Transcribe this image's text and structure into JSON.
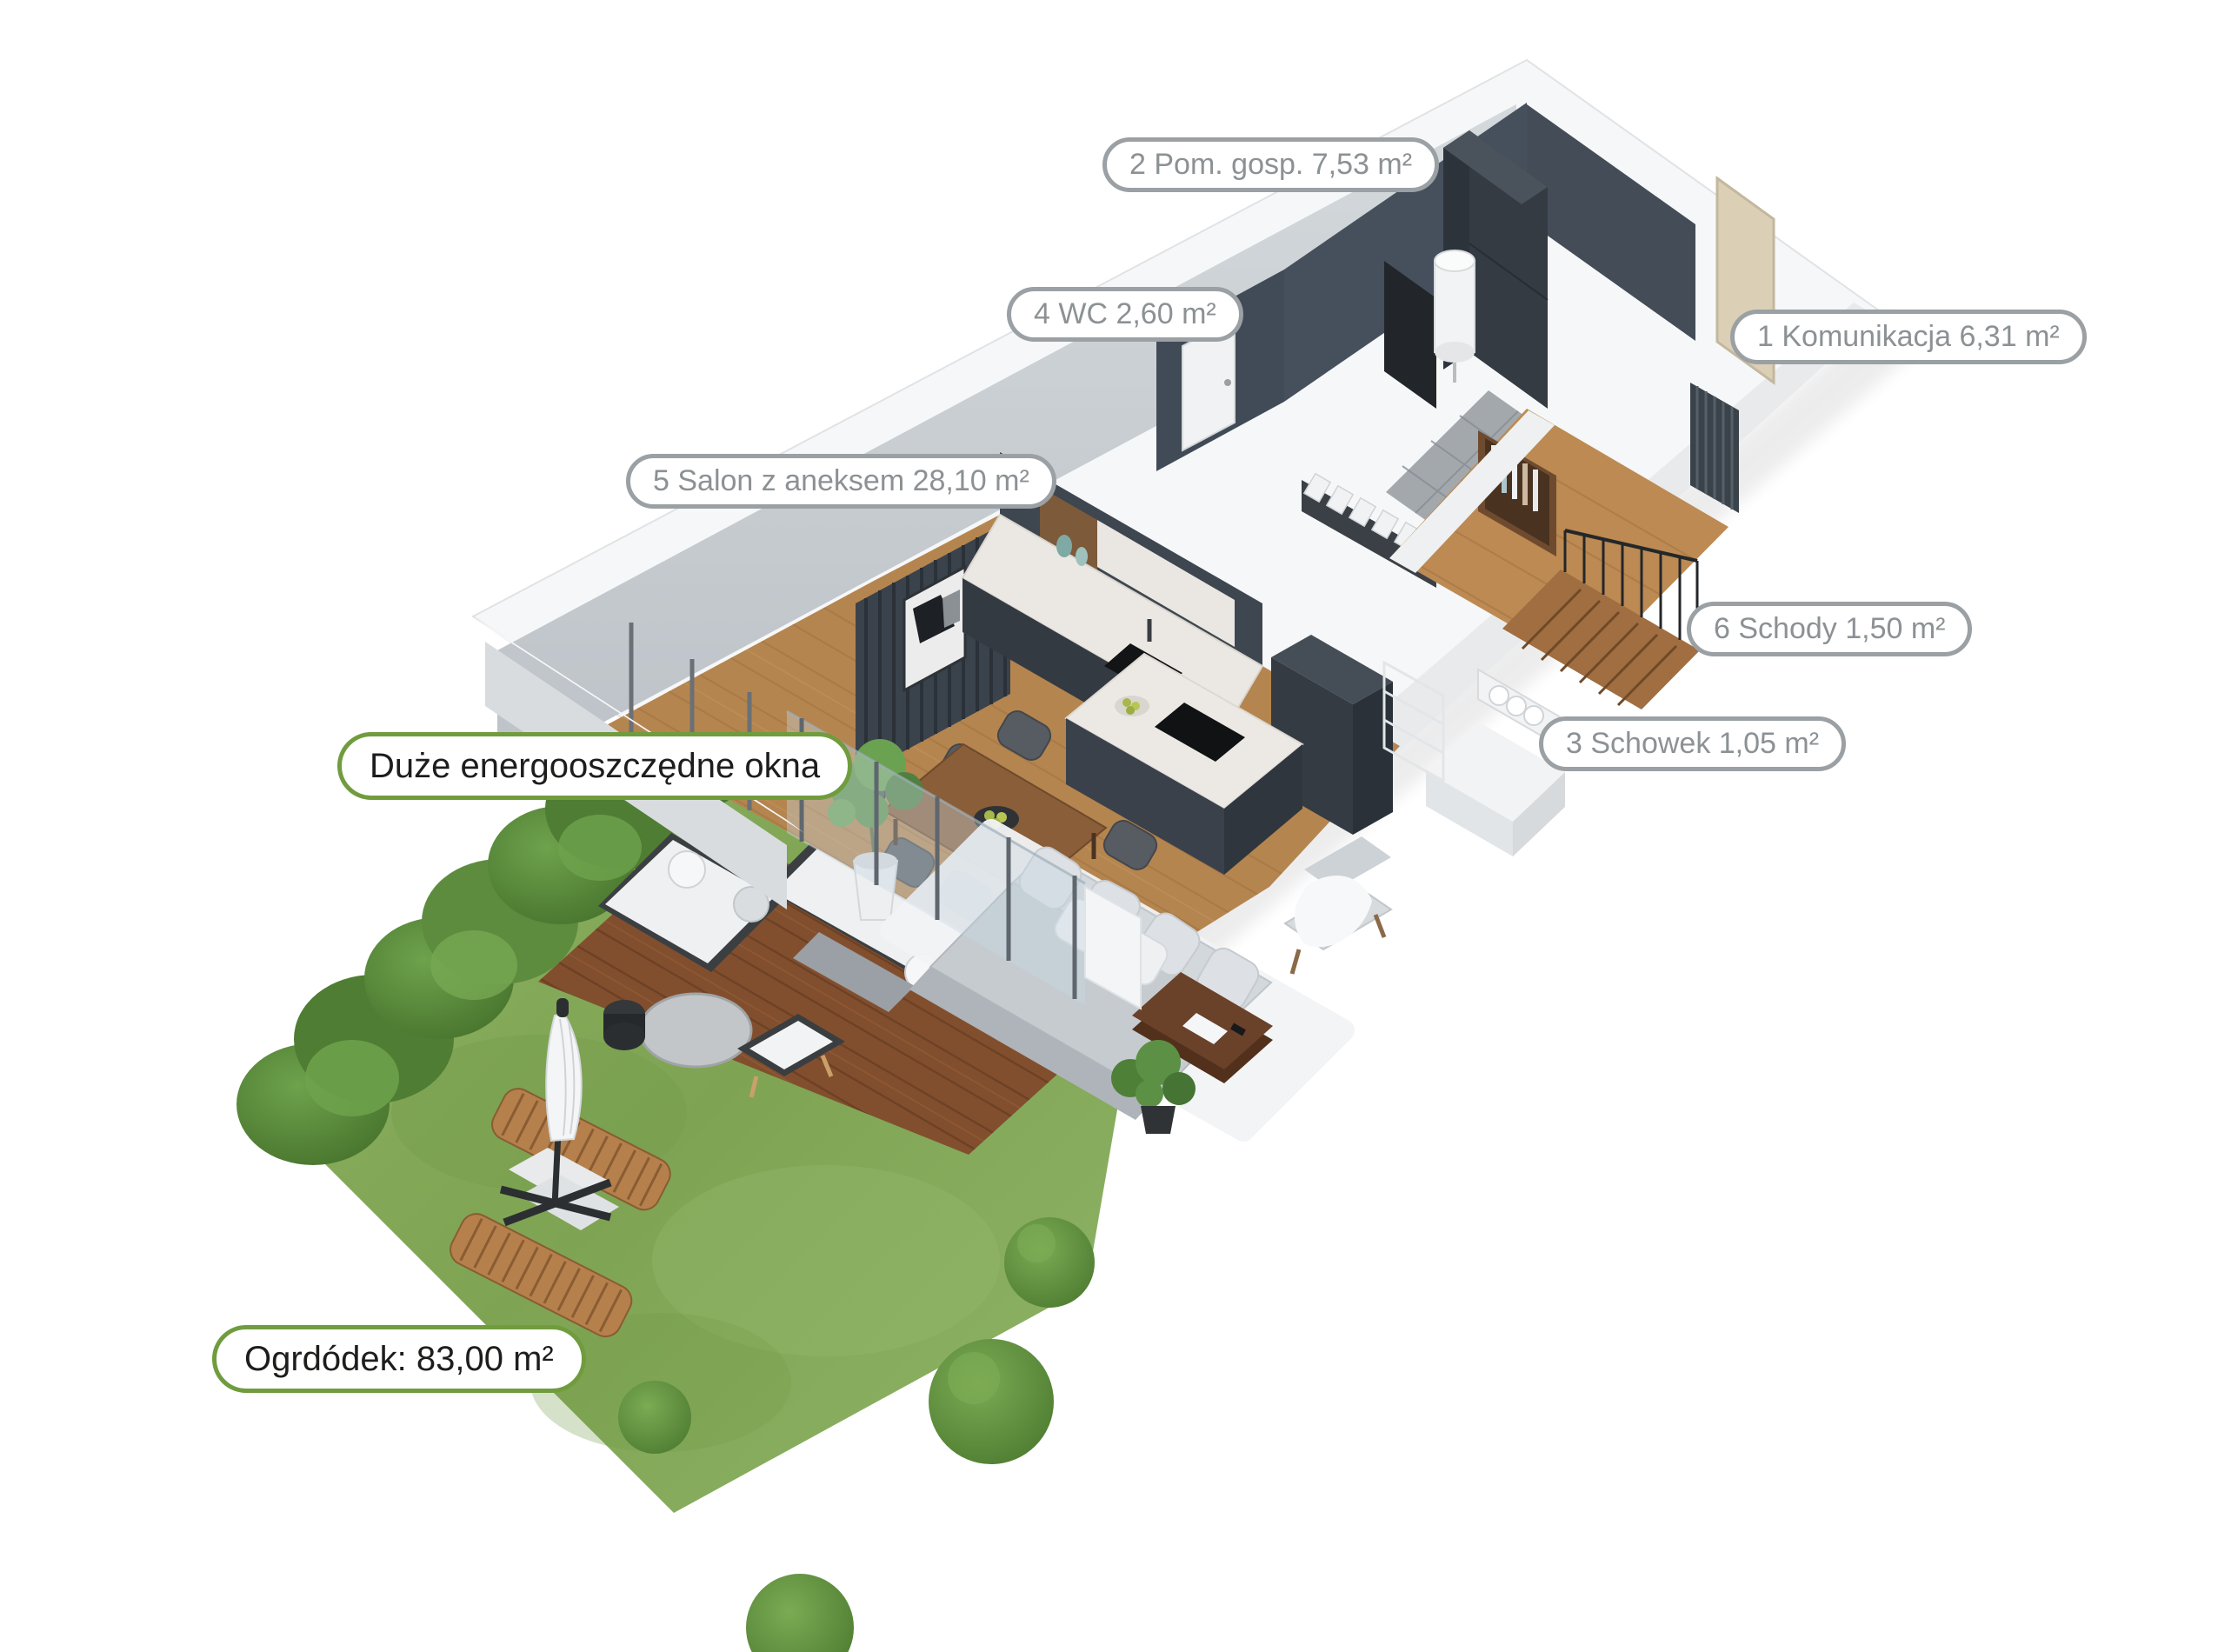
{
  "labels": {
    "rooms": [
      {
        "id": "pom_gosp",
        "number": "2",
        "name": "Pom. gosp.",
        "area": "7,53 m²",
        "text": "2 Pom. gosp. 7,53 m²"
      },
      {
        "id": "wc",
        "number": "4",
        "name": "WC",
        "area": "2,60 m²",
        "text": "4 WC 2,60 m²"
      },
      {
        "id": "komunikacja",
        "number": "1",
        "name": "Komunikacja",
        "area": "6,31 m²",
        "text": "1 Komunikacja 6,31 m²"
      },
      {
        "id": "salon",
        "number": "5",
        "name": "Salon z aneksem",
        "area": "28,10 m²",
        "text": "5 Salon z aneksem 28,10 m²"
      },
      {
        "id": "schody",
        "number": "6",
        "name": "Schody",
        "area": "1,50 m²",
        "text": "6 Schody 1,50 m²"
      },
      {
        "id": "schowek",
        "number": "3",
        "name": "Schowek",
        "area": "1,05 m²",
        "text": "3 Schowek 1,05 m²"
      }
    ],
    "features": [
      {
        "id": "okna",
        "text": "Duże energooszczędne okna"
      },
      {
        "id": "ogrodek",
        "text": "Ogrdódek: 83,00 m²"
      }
    ]
  },
  "colors": {
    "label_border_gray": "#9aa0a3",
    "label_text_gray": "#8c9194",
    "label_border_green": "#709c3e",
    "label_text_dark": "#1d1e1c",
    "grass": "#86ad5d",
    "hedge": "#567f36",
    "deck_wood": "#7e4f30",
    "interior_wood": "#b5854f",
    "dark_wall": "#46505c",
    "light_wall": "#cfd4d8",
    "tile_floor": "#a3a8ad",
    "kitchen_cabinet": "#343a41",
    "marble": "#ebe8e3"
  }
}
